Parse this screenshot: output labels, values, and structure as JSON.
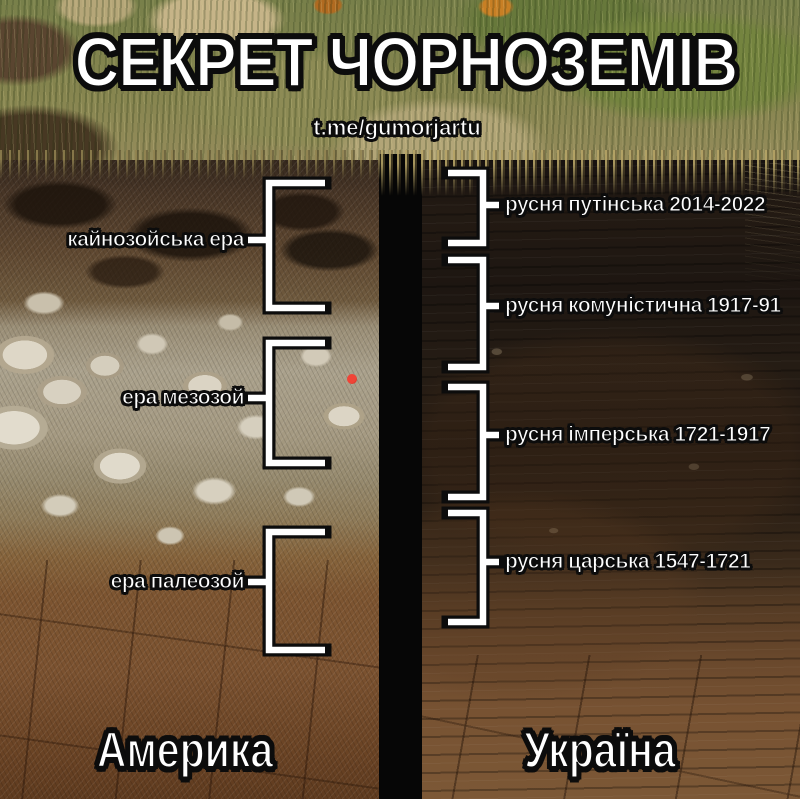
{
  "title": {
    "text": "СЕКРЕТ ЧОРНОЗЕМІВ"
  },
  "watermark": {
    "text": "t.me/gumorjartu"
  },
  "left_column": {
    "country_label": "Америка",
    "era_labels": [
      {
        "text": "кайнозойська ера"
      },
      {
        "text": "ера мезозой"
      },
      {
        "text": "ера палеозой"
      }
    ]
  },
  "right_column": {
    "country_label": "Україна",
    "period_labels": [
      {
        "text": "русня путінська 2014-2022"
      },
      {
        "text": "русня комуністична 1917-91"
      },
      {
        "text": "русня імперська 1721-1917"
      },
      {
        "text": "русня царська 1547-1721"
      }
    ]
  },
  "colors": {
    "annotation_white": "#ffffff",
    "outline_black": "#0c0c0c",
    "divider_black": "#060606",
    "red_marker": "#e8302e",
    "chernozem_dark": "#1d1611",
    "clay_brown": "#7b5230"
  }
}
